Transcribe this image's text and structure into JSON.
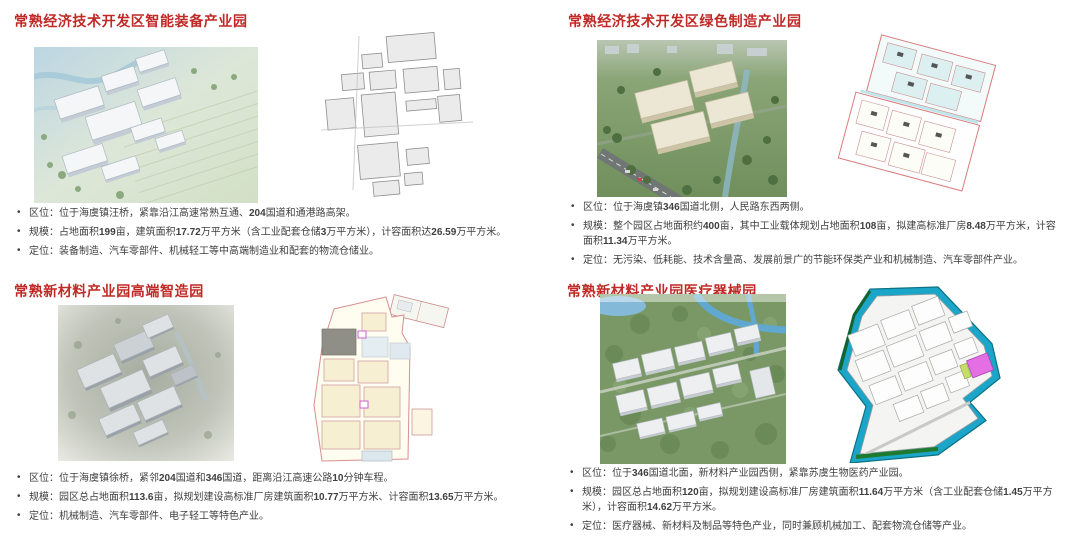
{
  "colors": {
    "title_red": "#c02a26",
    "body_text": "#3f3f3f",
    "plan_outline_red": "#d97c7c",
    "plan_teal": "#1ba6c9",
    "plan_magenta": "#e46ee4",
    "plan_green": "#1e7a2e",
    "plan_cream": "#f6efd2"
  },
  "slide": {
    "parks": [
      {
        "title": "常熟经济技术开发区智能装备产业园",
        "bullets": [
          "区位：位于海虞镇汪桥，紧靠沿江高速常熟互通、204国道和通港路高架。",
          "规模：占地面积199亩，建筑面积17.72万平方米（含工业配套仓储3万平方米），计容面积达26.59万平方米。",
          "定位：装备制造、汽车零部件、机械轻工等中高端制造业和配套的物流仓储业。"
        ]
      },
      {
        "title": "常熟经济技术开发区绿色制造产业园",
        "bullets": [
          "区位：位于海虞镇346国道北侧，人民路东西两侧。",
          "规模：整个园区占地面积约400亩，其中工业载体规划占地面积108亩，拟建高标准厂房8.48万平方米，计容面积11.34万平方米。",
          "定位：无污染、低耗能、技术含量高、发展前景广的节能环保类产业和机械制造、汽车零部件产业。"
        ]
      },
      {
        "title": "常熟新材料产业园高端智造园",
        "bullets": [
          "区位：位于海虞镇徐桥，紧邻204国道和346国道，距离沿江高速公路10分钟车程。",
          "规模：园区总占地面积113.6亩，拟规划建设高标准厂房建筑面积10.77万平方米、计容面积13.65万平方米。",
          "定位：机械制造、汽车零部件、电子轻工等特色产业。"
        ]
      },
      {
        "title": "常熟新材料产业园医疗器械园",
        "bullets": [
          "区位：位于346国道北面，新材料产业园西侧，紧靠苏虞生物医药产业园。",
          "规模：园区总占地面积120亩，拟规划建设高标准厂房建筑面积11.64万平方米（含工业配套仓储1.45万平方米），计容面积14.62万平方米。",
          "定位：医疗器械、新材料及制品等特色产业，同时兼顾机械加工、配套物流仓储等产业。"
        ]
      }
    ]
  }
}
